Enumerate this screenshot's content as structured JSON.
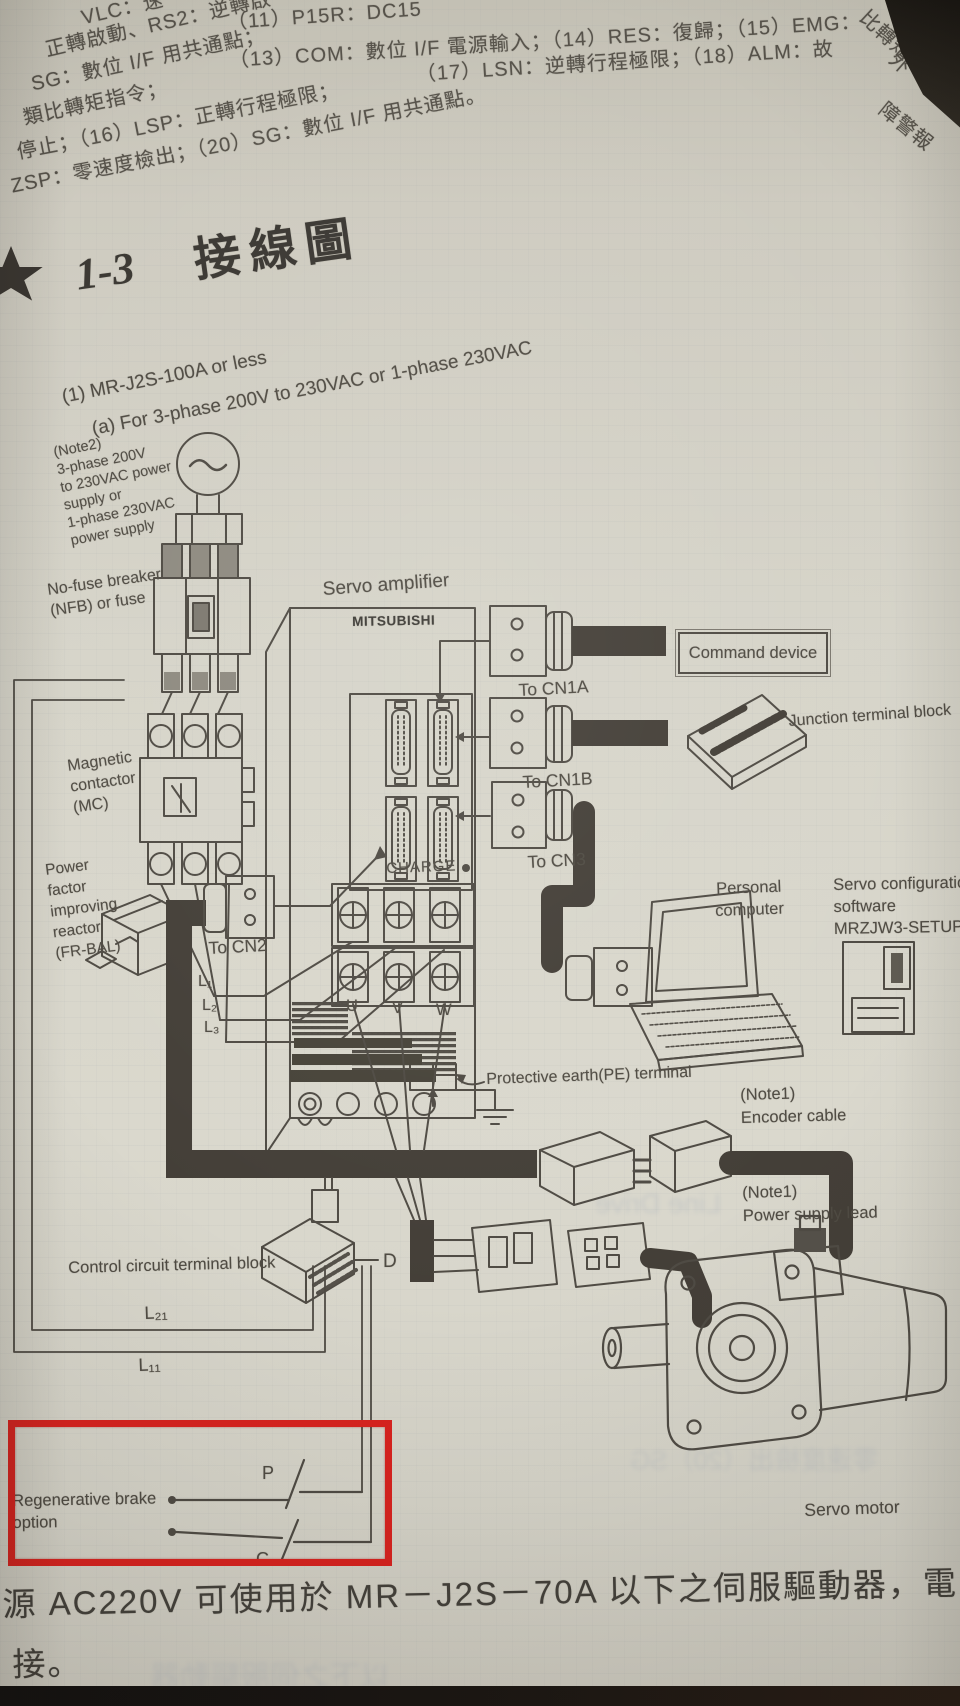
{
  "top_text": {
    "fragments": [
      "VLC：速",
      "正轉啟動、RS2：逆轉啟",
      "（11）P15R：DC15",
      "SG：數位 I/F 用共通點；",
      "（13）COM：數位 I/F 電源輸入；（14）RES：復歸；（15）EMG：",
      "類比轉矩指令；",
      "停止；（16）LSP：正轉行程極限；",
      "（17）LSN：逆轉行程極限；（18）ALM：故",
      "ZSP：零速度檢出；（20）SG：數位 I/F 用共通點。"
    ],
    "curls": [
      "比轉矩限制",
      "外",
      "障警報"
    ]
  },
  "heading": {
    "number": "1-3",
    "title": "接線圖"
  },
  "figure": {
    "caption_model": "(1) MR-J2S-100A or less",
    "caption_phase": "(a) For 3-phase 200V to 230VAC or 1-phase 230VAC",
    "note2": [
      "(Note2)",
      "3-phase 200V",
      "to 230VAC power",
      "supply or",
      "1-phase 230VAC",
      "power supply"
    ],
    "nfb": [
      "No-fuse breaker",
      "(NFB) or fuse"
    ],
    "mc": [
      "Magnetic",
      "contactor",
      "(MC)"
    ],
    "reactor": [
      "Power",
      "factor",
      "improving",
      "reactor",
      "(FR-BAL)"
    ],
    "servo_amplifier": "Servo amplifier",
    "brand": "MITSUBISHI",
    "charge": "CHARGE",
    "to_cn1a": "To CN1A",
    "to_cn1b": "To CN1B",
    "to_cn3": "To CN3",
    "to_cn2": "To CN2",
    "terminals": {
      "l1": "L₁",
      "l2": "L₂",
      "l3": "L₃",
      "u": "U",
      "v": "V",
      "w": "W",
      "l21": "L₂₁",
      "l11": "L₁₁",
      "d": "D",
      "p": "P",
      "c": "C"
    },
    "command_device": "Command device",
    "junction_block": "Junction terminal block",
    "personal_computer": [
      "Personal",
      "computer"
    ],
    "software": [
      "Servo configuration",
      "software",
      "MRZJW3-SETUP"
    ],
    "pe_terminal": "Protective earth(PE) terminal",
    "encoder_cable": [
      "(Note1)",
      "Encoder cable"
    ],
    "power_lead": [
      "(Note1)",
      "Power supply lead"
    ],
    "control_block": "Control circuit terminal block",
    "regen_option": [
      "Regenerative brake",
      "option"
    ],
    "servo_motor": "Servo motor"
  },
  "bottom_text": {
    "line1": "源 AC220V 可使用於 MR－J2S－70A 以下之伺服驅動器，電",
    "line2": "接。"
  },
  "ghost_texts": [
    "Line Drive",
    "零速度檢出（20）SG",
    "以下之伺服驅動器"
  ],
  "colors": {
    "highlight_red": "#d8231f",
    "ink": "#4f4b44",
    "paper": "#d6d4c9",
    "cable": "#443f38"
  }
}
